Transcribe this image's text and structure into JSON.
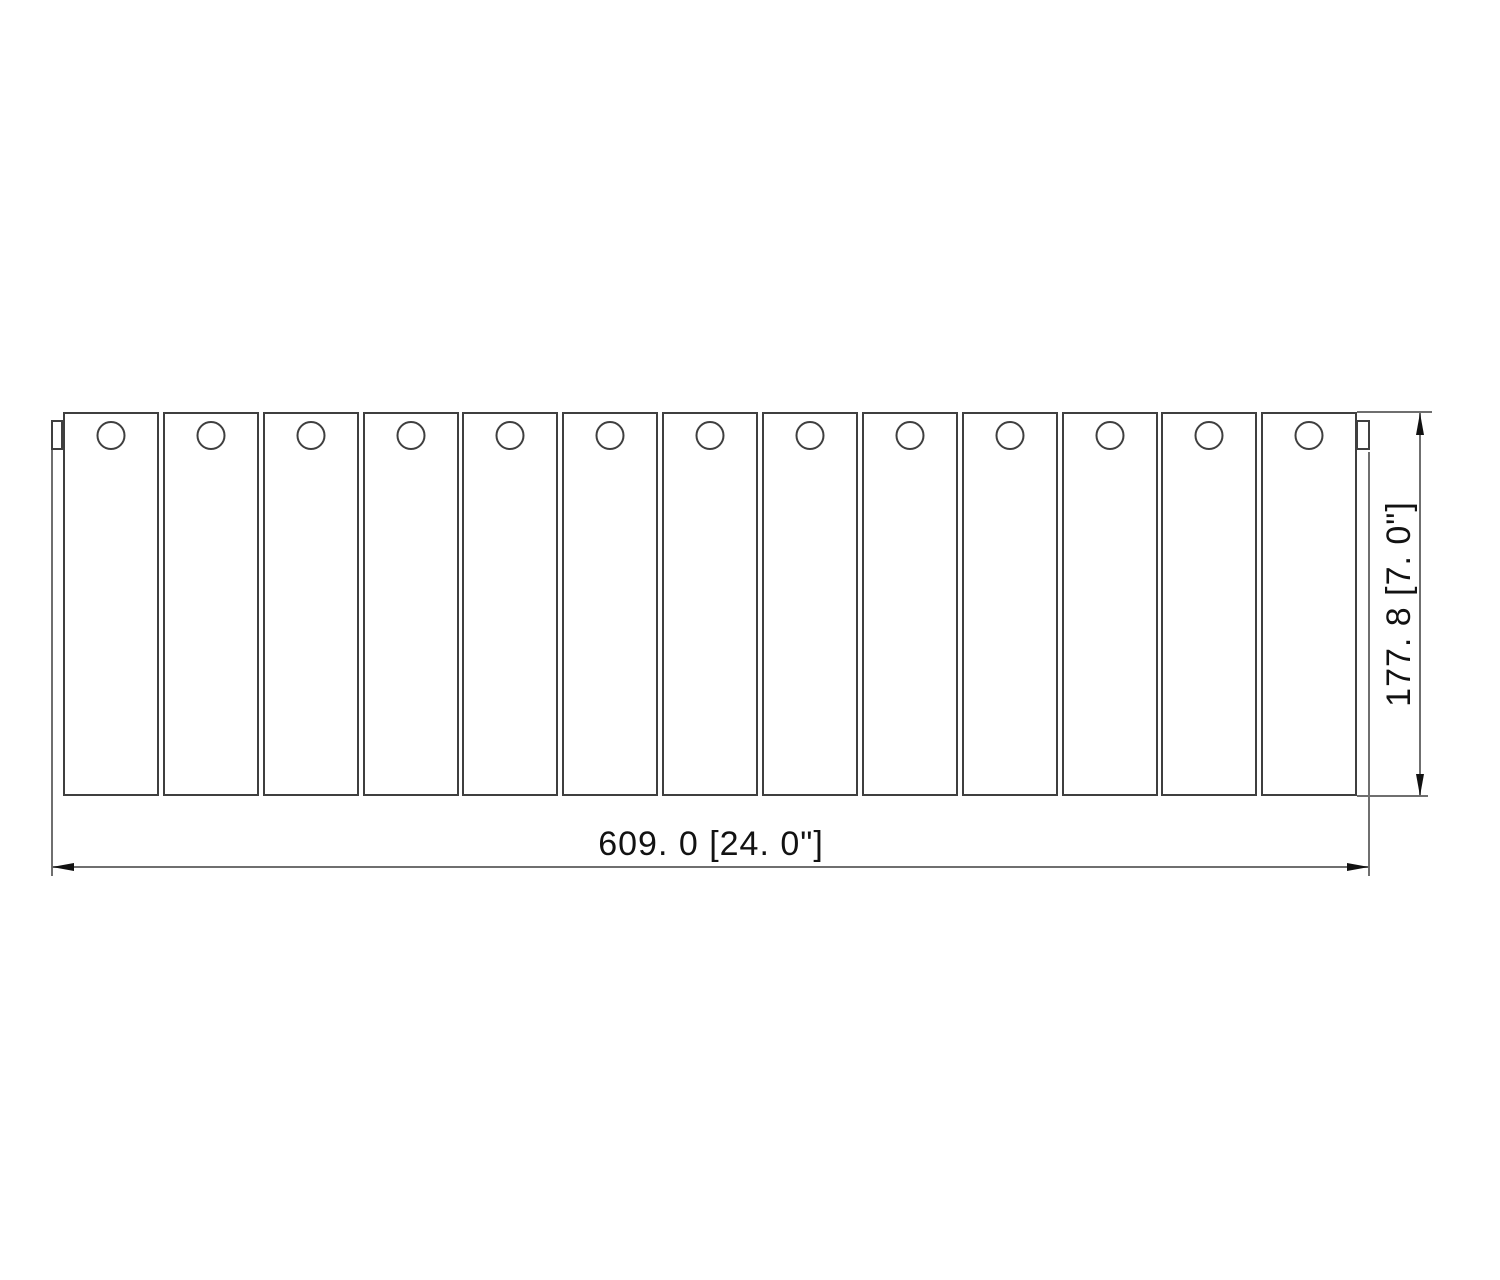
{
  "figure": {
    "description": "Front view technical drawing of a slatted panel assembly with a round mounting hole in each slat and small mounting tabs on both upper corners",
    "panel_count": 13,
    "hole_shape": "circle"
  },
  "dimensions": {
    "width": {
      "label": "609. 0 [24. 0\"]",
      "value_mm": "609.0",
      "value_in": "24.0\""
    },
    "height": {
      "label": "177. 8 [7. 0\"]",
      "value_mm": "177.8",
      "value_in": "7.0\""
    }
  },
  "colors": {
    "background": "#ffffff",
    "outline": "#3f3f3f",
    "dimension_line": "#6f6f6f",
    "arrow": "#111111",
    "text": "#121212"
  }
}
